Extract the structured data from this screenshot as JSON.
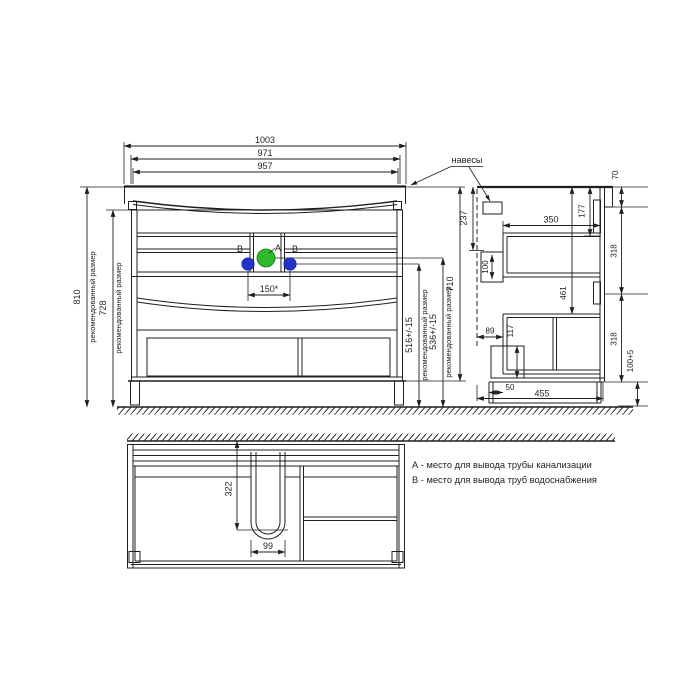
{
  "meta": {
    "background": "#ffffff",
    "line_color": "#1f1f1f",
    "drain_color": "#2eb82e",
    "water_color": "#2333cc"
  },
  "front_view": {
    "dim_width_outer": "1003",
    "dim_width_mid": "971",
    "dim_width_inner": "957",
    "dim_height_total": "810",
    "dim_height_body_floor": "728",
    "label_recommended": "рекомендованный размер",
    "dim_pipes_span": "150*",
    "dim_water_height": "516+/-15",
    "dim_drain_height": "536+/-15",
    "dim_carcass_height": "710",
    "dim_hanger_drop": "237",
    "label_hangers": "навесы",
    "label_drain_point": "A",
    "label_water_point": "B"
  },
  "side_view": {
    "dim_depth_top": "350",
    "dim_rail_drop": "177",
    "dim_back_top": "70",
    "dim_upper_section": "318",
    "dim_lower_section": "318",
    "dim_niche_height": "100",
    "dim_rail_mid_drop": "461",
    "dim_front_gap": "89",
    "dim_box_height": "117",
    "dim_plinth_height": "100+5",
    "dim_plinth_recess": "50",
    "dim_total_depth": "455"
  },
  "bottom_view": {
    "dim_cutout_depth": "322",
    "dim_cutout_width": "99"
  },
  "legend": {
    "line_a": "А - место для вывода трубы канализации",
    "line_b": "В - место для вывода труб водоснабжения"
  }
}
